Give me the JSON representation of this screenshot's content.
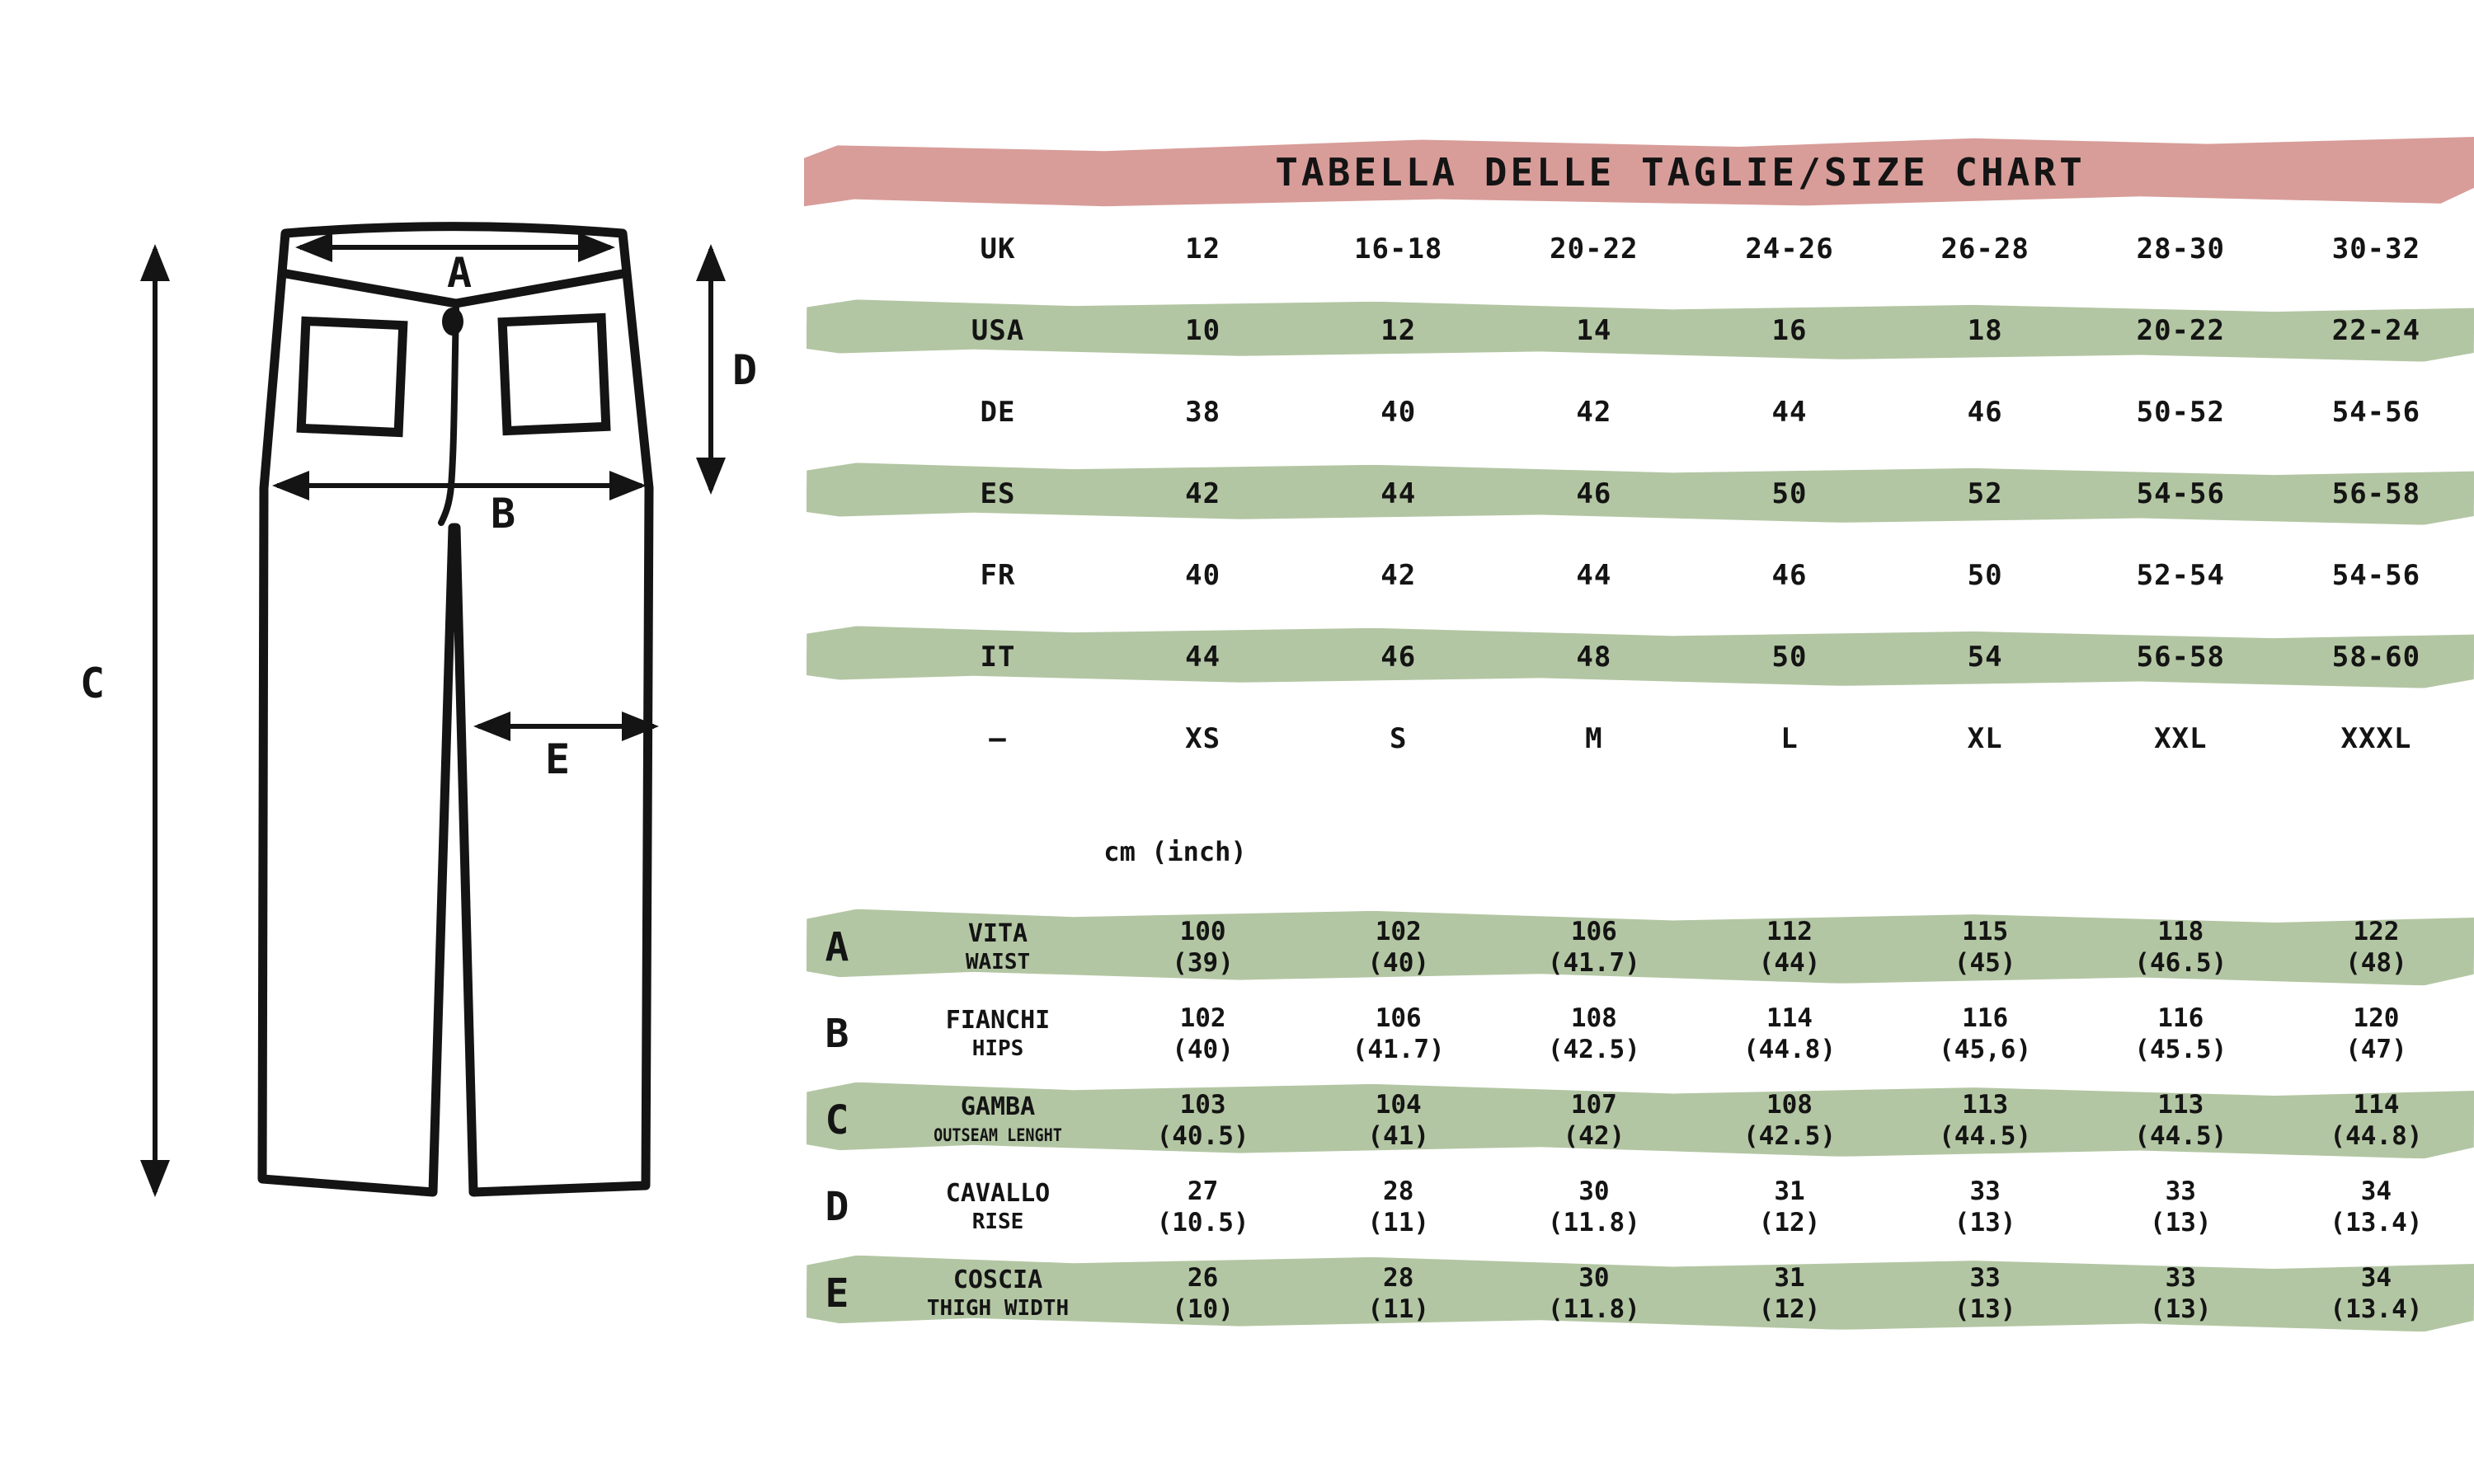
{
  "title": "TABELLA DELLE TAGLIE/SIZE CHART",
  "unit_label": "cm (inch)",
  "colors": {
    "pink": "#d89d99",
    "green": "#b3c6a3",
    "ink": "#141414"
  },
  "diagram": {
    "labels": {
      "a": "A",
      "b": "B",
      "c": "C",
      "d": "D",
      "e": "E"
    }
  },
  "size_table": {
    "rows": [
      {
        "label": "UK",
        "highlight": false,
        "values": [
          "12",
          "16-18",
          "20-22",
          "24-26",
          "26-28",
          "28-30",
          "30-32"
        ]
      },
      {
        "label": "USA",
        "highlight": true,
        "values": [
          "10",
          "12",
          "14",
          "16",
          "18",
          "20-22",
          "22-24"
        ]
      },
      {
        "label": "DE",
        "highlight": false,
        "values": [
          "38",
          "40",
          "42",
          "44",
          "46",
          "50-52",
          "54-56"
        ]
      },
      {
        "label": "ES",
        "highlight": true,
        "values": [
          "42",
          "44",
          "46",
          "50",
          "52",
          "54-56",
          "56-58"
        ]
      },
      {
        "label": "FR",
        "highlight": false,
        "values": [
          "40",
          "42",
          "44",
          "46",
          "50",
          "52-54",
          "54-56"
        ]
      },
      {
        "label": "IT",
        "highlight": true,
        "values": [
          "44",
          "46",
          "48",
          "50",
          "54",
          "56-58",
          "58-60"
        ]
      },
      {
        "label": "–",
        "highlight": false,
        "values": [
          "XS",
          "S",
          "M",
          "L",
          "XL",
          "XXL",
          "XXXL"
        ]
      }
    ]
  },
  "measurement_table": {
    "rows": [
      {
        "letter": "A",
        "label_it": "VITA",
        "label_en": "WAIST",
        "highlight": true,
        "values_cm": [
          "100",
          "102",
          "106",
          "112",
          "115",
          "118",
          "122"
        ],
        "values_inch": [
          "(39)",
          "(40)",
          "(41.7)",
          "(44)",
          "(45)",
          "(46.5)",
          "(48)"
        ]
      },
      {
        "letter": "B",
        "label_it": "FIANCHI",
        "label_en": "HIPS",
        "highlight": false,
        "values_cm": [
          "102",
          "106",
          "108",
          "114",
          "116",
          "116",
          "120"
        ],
        "values_inch": [
          "(40)",
          "(41.7)",
          "(42.5)",
          "(44.8)",
          "(45,6)",
          "(45.5)",
          "(47)"
        ]
      },
      {
        "letter": "C",
        "label_it": "GAMBA",
        "label_en": "OUTSEAM LENGHT",
        "highlight": true,
        "values_cm": [
          "103",
          "104",
          "107",
          "108",
          "113",
          "113",
          "114"
        ],
        "values_inch": [
          "(40.5)",
          "(41)",
          "(42)",
          "(42.5)",
          "(44.5)",
          "(44.5)",
          "(44.8)"
        ]
      },
      {
        "letter": "D",
        "label_it": "CAVALLO",
        "label_en": "RISE",
        "highlight": false,
        "values_cm": [
          "27",
          "28",
          "30",
          "31",
          "33",
          "33",
          "34"
        ],
        "values_inch": [
          "(10.5)",
          "(11)",
          "(11.8)",
          "(12)",
          "(13)",
          "(13)",
          "(13.4)"
        ]
      },
      {
        "letter": "E",
        "label_it": "COSCIA",
        "label_en": "THIGH WIDTH",
        "highlight": true,
        "values_cm": [
          "26",
          "28",
          "30",
          "31",
          "33",
          "33",
          "34"
        ],
        "values_inch": [
          "(10)",
          "(11)",
          "(11.8)",
          "(12)",
          "(13)",
          "(13)",
          "(13.4)"
        ]
      }
    ]
  },
  "chart_data": [
    {
      "type": "table",
      "title": "TABELLA DELLE TAGLIE/SIZE CHART",
      "row_headers": [
        "UK",
        "USA",
        "DE",
        "ES",
        "FR",
        "IT",
        "–"
      ],
      "rows": [
        [
          "12",
          "16-18",
          "20-22",
          "24-26",
          "26-28",
          "28-30",
          "30-32"
        ],
        [
          "10",
          "12",
          "14",
          "16",
          "18",
          "20-22",
          "22-24"
        ],
        [
          "38",
          "40",
          "42",
          "44",
          "46",
          "50-52",
          "54-56"
        ],
        [
          "42",
          "44",
          "46",
          "50",
          "52",
          "54-56",
          "56-58"
        ],
        [
          "40",
          "42",
          "44",
          "46",
          "50",
          "52-54",
          "54-56"
        ],
        [
          "44",
          "46",
          "48",
          "50",
          "54",
          "56-58",
          "58-60"
        ],
        [
          "XS",
          "S",
          "M",
          "L",
          "XL",
          "XXL",
          "XXXL"
        ]
      ]
    },
    {
      "type": "table",
      "title": "cm (inch)",
      "row_headers": [
        "A VITA/WAIST",
        "B FIANCHI/HIPS",
        "C GAMBA/OUTSEAM LENGHT",
        "D CAVALLO/RISE",
        "E COSCIA/THIGH WIDTH"
      ],
      "rows": [
        [
          "100 (39)",
          "102 (40)",
          "106 (41.7)",
          "112 (44)",
          "115 (45)",
          "118 (46.5)",
          "122 (48)"
        ],
        [
          "102 (40)",
          "106 (41.7)",
          "108 (42.5)",
          "114 (44.8)",
          "116 (45,6)",
          "116 (45.5)",
          "120 (47)"
        ],
        [
          "103 (40.5)",
          "104 (41)",
          "107 (42)",
          "108 (42.5)",
          "113 (44.5)",
          "113 (44.5)",
          "114 (44.8)"
        ],
        [
          "27 (10.5)",
          "28 (11)",
          "30 (11.8)",
          "31 (12)",
          "33 (13)",
          "33 (13)",
          "34 (13.4)"
        ],
        [
          "26 (10)",
          "28 (11)",
          "30 (11.8)",
          "31 (12)",
          "33 (13)",
          "33 (13)",
          "34 (13.4)"
        ]
      ]
    }
  ]
}
